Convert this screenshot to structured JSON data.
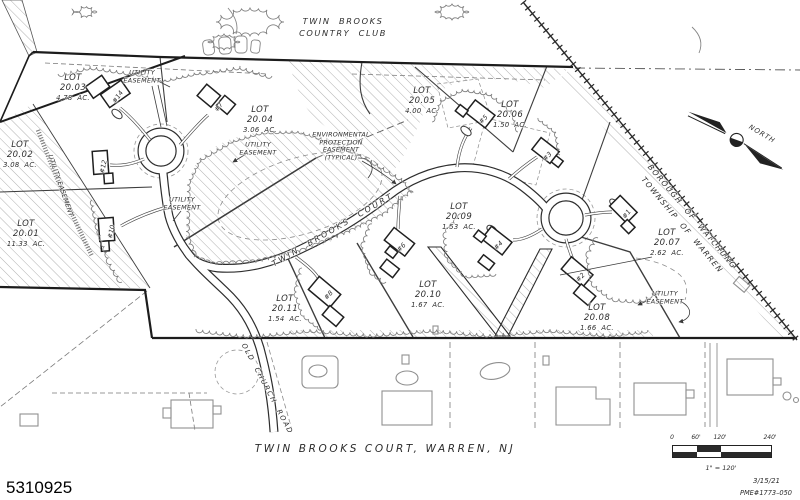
{
  "map": {
    "title": [
      "TWIN  BROOKS",
      "COUNTRY  CLUB"
    ],
    "caption": "TWIN  BROOKS  COURT,  WARREN,  NJ",
    "listing_number": "5310925",
    "north_label": "NORTH",
    "lot_word": "LOT",
    "municipal_boundary": [
      "BOROUGH  OF  WATCHUNG",
      "TOWNSHIP  OF  WARREN"
    ],
    "environmental_label": [
      "ENVIRONMENTAL",
      "PROTECTION",
      "EASEMENT",
      "(TYPICAL)"
    ],
    "utility_easement_lines": [
      "UTILITY",
      "EASEMENT"
    ],
    "utility_easement_single": "UTILITY EASEMENT",
    "streets": [
      {
        "text": "TWIN  BROOKS  COURT",
        "x": 333,
        "y": 230,
        "rot": -30,
        "size": 8,
        "ls": 2.4
      },
      {
        "text": "OLD  CHURCH  ROAD",
        "x": 267,
        "y": 389,
        "rot": 62,
        "size": 7,
        "ls": 1.6
      }
    ],
    "lots": [
      {
        "num": "20.03",
        "acres": "4.78  AC.",
        "x": 73,
        "y": 88
      },
      {
        "num": "20.04",
        "acres": "3.06  AC.",
        "x": 260,
        "y": 120
      },
      {
        "num": "20.02",
        "acres": "3.08  AC.",
        "x": 20,
        "y": 155
      },
      {
        "num": "20.01",
        "acres": "11.33  AC.",
        "x": 26,
        "y": 234
      },
      {
        "num": "20.05",
        "acres": "4.00  AC.",
        "x": 422,
        "y": 101
      },
      {
        "num": "20.06",
        "acres": "1.50  AC.",
        "x": 510,
        "y": 115
      },
      {
        "num": "20.09",
        "acres": "1.53  AC.",
        "x": 459,
        "y": 217
      },
      {
        "num": "20.07",
        "acres": "2.62  AC.",
        "x": 667,
        "y": 243
      },
      {
        "num": "20.10",
        "acres": "1.67  AC.",
        "x": 428,
        "y": 295
      },
      {
        "num": "20.11",
        "acres": "1.54  AC.",
        "x": 285,
        "y": 309
      },
      {
        "num": "20.08",
        "acres": "1.66  AC.",
        "x": 597,
        "y": 318
      }
    ],
    "houses": [
      {
        "label": "#14",
        "x": 115,
        "y": 95,
        "rot": -55
      },
      {
        "label": "#7",
        "x": 216,
        "y": 105,
        "rot": -55
      },
      {
        "label": "#12",
        "x": 100,
        "y": 166,
        "rot": -78
      },
      {
        "label": "#10",
        "x": 108,
        "y": 231,
        "rot": -78
      },
      {
        "label": "#5",
        "x": 481,
        "y": 117,
        "rot": -45
      },
      {
        "label": "#3",
        "x": 545,
        "y": 154,
        "rot": -45
      },
      {
        "label": "#6",
        "x": 399,
        "y": 245,
        "rot": -45
      },
      {
        "label": "#4",
        "x": 496,
        "y": 243,
        "rot": -45
      },
      {
        "label": "#8",
        "x": 326,
        "y": 293,
        "rot": -48
      },
      {
        "label": "#2",
        "x": 578,
        "y": 275,
        "rot": -45
      },
      {
        "label": "#1",
        "x": 624,
        "y": 212,
        "rot": -52
      }
    ],
    "utility_labels": [
      {
        "x": 142,
        "y": 77,
        "rot": 0
      },
      {
        "x": 258,
        "y": 149,
        "rot": 0
      },
      {
        "x": 182,
        "y": 204,
        "rot": 0
      },
      {
        "x": 665,
        "y": 298,
        "rot": 0
      }
    ],
    "utility_label_rotated": {
      "x": 60,
      "y": 186,
      "rot": 71
    },
    "scale_bar": {
      "ticks": [
        "0",
        "60'",
        "120'",
        "240'"
      ],
      "ratio": "1\" = 120'",
      "date": "3/15/21",
      "ref": "PME#1773–050"
    }
  }
}
